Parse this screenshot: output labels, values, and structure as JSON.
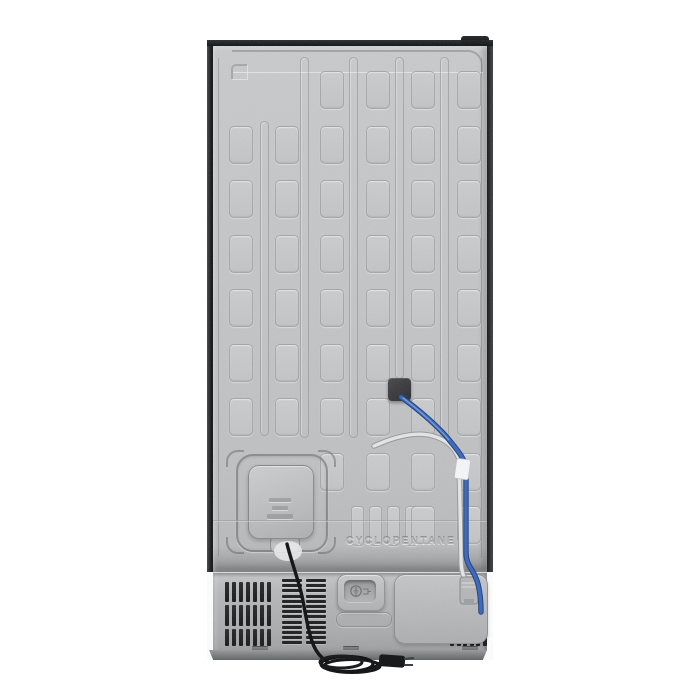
{
  "meta": {
    "description": "Product photograph: rear view of a stainless refrigerator on white background",
    "background_color": "#ffffff"
  },
  "labels": {
    "cyclopentane": "CYCLOPENTANE"
  },
  "panel": {
    "color": "#c5c6c8",
    "frame_color": "#1a1b1d",
    "grid": {
      "rect_w": 22,
      "rect_h": 36,
      "radius": 5,
      "cols_x": [
        229,
        274.5,
        320,
        365.5,
        411,
        456.5
      ],
      "rows_y": [
        71,
        125.5,
        180,
        234.5,
        289,
        343.5,
        398,
        452.5
      ],
      "skip": [
        [
          0,
          0
        ],
        [
          1,
          0
        ],
        [
          0,
          7
        ],
        [
          1,
          7
        ]
      ],
      "small_slots": {
        "y": 506,
        "w": 11,
        "h": 38,
        "xs": [
          350.5,
          368.5,
          386.5,
          404.5
        ]
      },
      "extra_rects": [
        [
          411,
          506
        ],
        [
          456.5,
          506
        ]
      ]
    },
    "channels": [
      {
        "x": 263,
        "top": 121,
        "bottom": 434
      },
      {
        "x": 303,
        "top": 57,
        "bottom": 436
      },
      {
        "x": 352,
        "top": 57,
        "bottom": 436
      },
      {
        "x": 398,
        "top": 57,
        "bottom": 377
      },
      {
        "x": 443,
        "top": 57,
        "bottom": 436
      }
    ]
  },
  "junction_box": {
    "x": 388,
    "y": 378,
    "w": 23,
    "h": 23,
    "color": "#323236"
  },
  "tubes": {
    "water_line_color": "#3e6bbd",
    "water_line_edge": "#28477e",
    "drain_tube_color": "#e2e3e5",
    "drain_tube_edge": "#9b9c9e",
    "tape_color": "#f2f3f5",
    "fitting_color": "#b5b6b8"
  },
  "power_cord": {
    "color": "#17181a",
    "plug_color": "#1a1b1d"
  },
  "bottom_section": {
    "grille_left": {
      "x": 225,
      "slats": 7,
      "slat_w": 4,
      "gap": 3,
      "rows_y": [
        582,
        605,
        629
      ],
      "rows_h": [
        20,
        21,
        17
      ]
    },
    "grille_right": {
      "x": 450,
      "slats": 6,
      "slat_w": 4,
      "gap": 2.5,
      "rows_y": [
        582,
        605,
        629
      ],
      "rows_h": [
        20,
        21,
        17
      ],
      "row1_slats": 2
    },
    "louver_cols": {
      "xs": [
        282,
        306
      ],
      "w": 20,
      "top": 579,
      "count": 13,
      "slat_h": 3,
      "gap": 2.2
    },
    "screw_tabs_x": [
      252,
      343,
      462
    ],
    "screw_tabs_y": 646
  }
}
